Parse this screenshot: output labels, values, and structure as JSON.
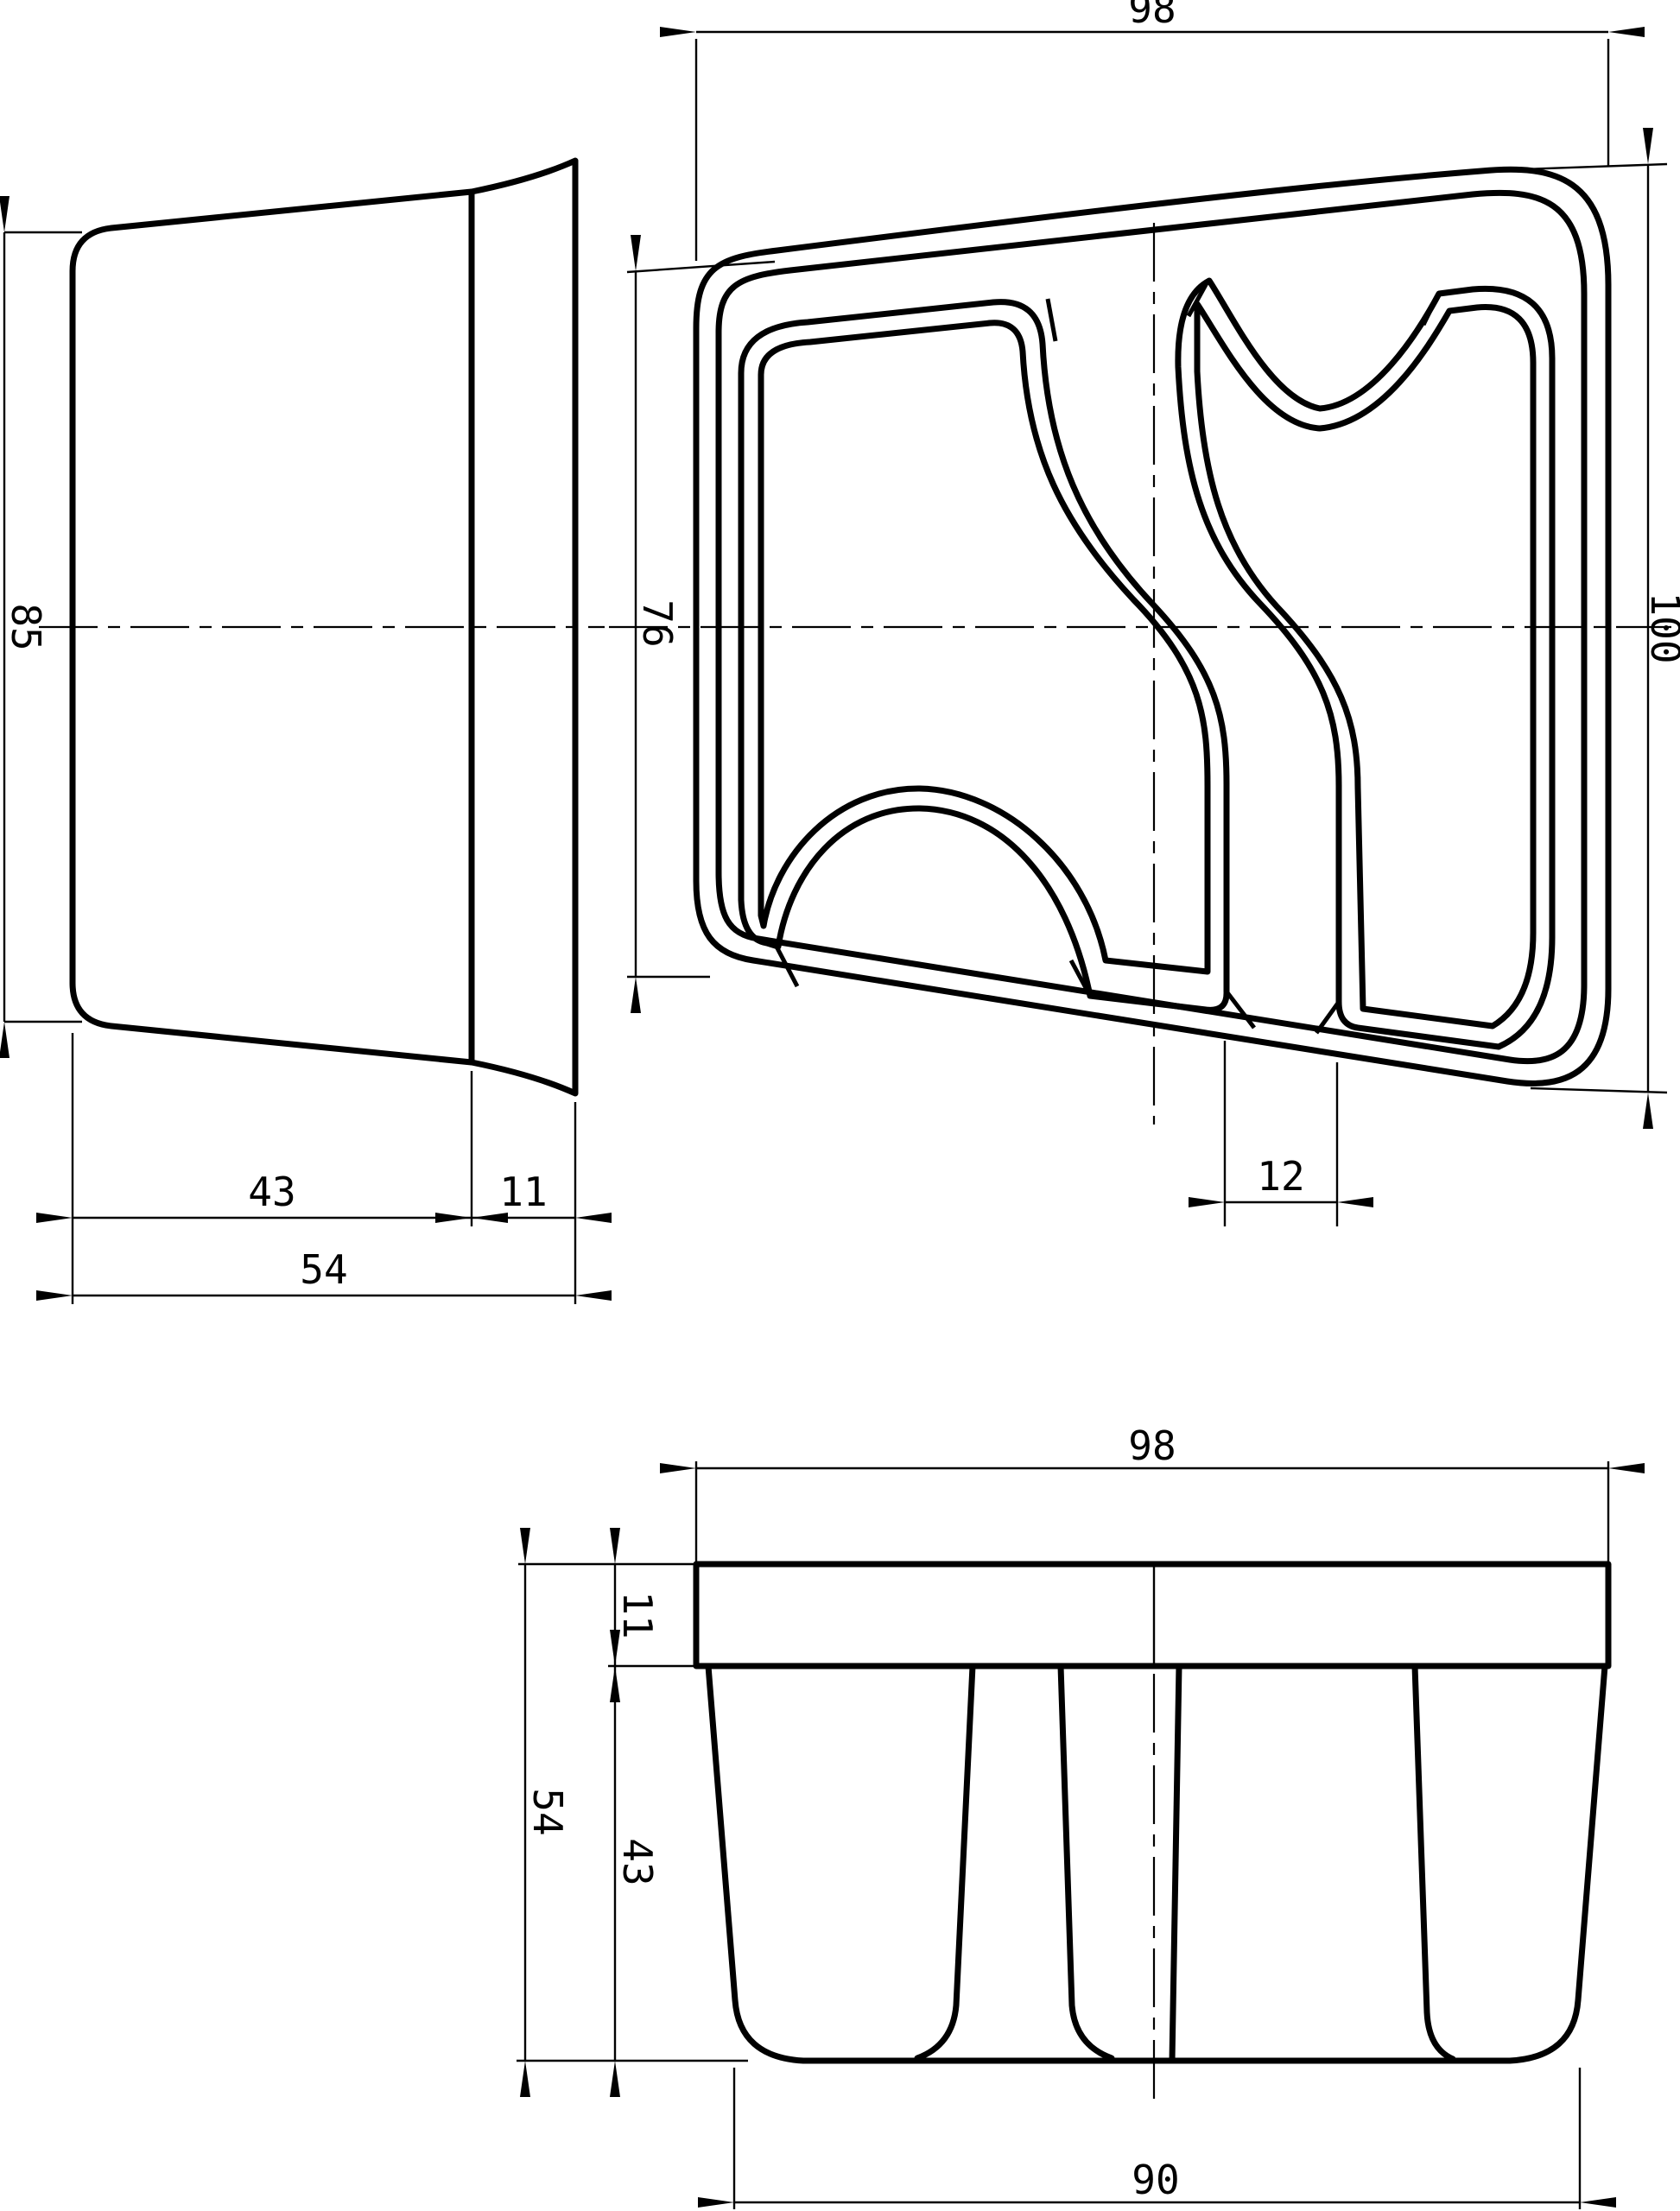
{
  "drawing": {
    "background": "#ffffff",
    "line_color": "#000000",
    "views": {
      "side_view": {
        "dims": {
          "height": "85",
          "body_width": "43",
          "rim_width": "11",
          "total_width": "54"
        }
      },
      "front_view": {
        "dims": {
          "width": "98",
          "left_height": "76",
          "right_height": "100",
          "divider_width": "12"
        }
      },
      "bottom_view": {
        "dims": {
          "width": "98",
          "rim_depth": "11",
          "body_depth": "43",
          "total_depth": "54",
          "base_width": "90"
        }
      }
    }
  }
}
